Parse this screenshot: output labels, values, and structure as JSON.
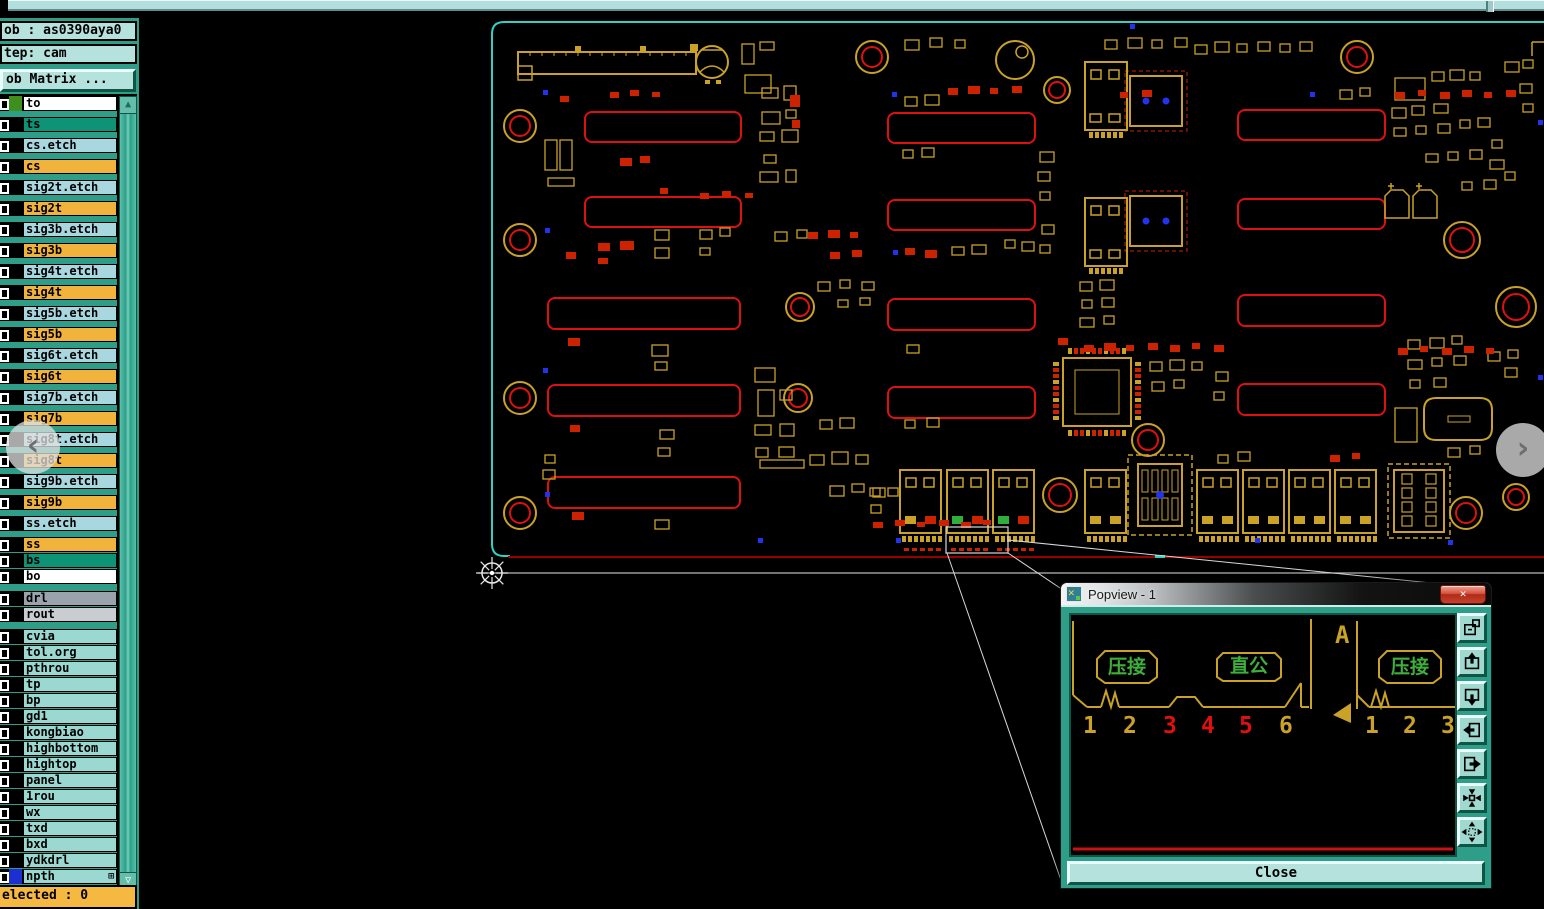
{
  "window": {
    "top_strip": "window-edge"
  },
  "panel": {
    "job_field": "ob : as0390aya0",
    "step_field": "tep: cam",
    "matrix_button": "ob Matrix ...",
    "status": "elected : 0",
    "scroll_up": "▲",
    "scroll_down": "▽",
    "npth_badge": "⊞",
    "layers": [
      {
        "name": "to",
        "bg": "#ffffff",
        "swatch": "#3f8f1f",
        "g": 6
      },
      {
        "name": "ts",
        "bg": "#0f9377",
        "g": 6
      },
      {
        "name": "cs.etch",
        "bg": "#a9d7e0",
        "g": 6
      },
      {
        "name": "cs",
        "bg": "#f2b33d",
        "g": 6
      },
      {
        "name": "sig2t.etch",
        "bg": "#a9d7e0",
        "g": 6
      },
      {
        "name": "sig2t",
        "bg": "#f2b33d",
        "g": 6
      },
      {
        "name": "sig3b.etch",
        "bg": "#a9d7e0",
        "g": 6
      },
      {
        "name": "sig3b",
        "bg": "#f2b33d",
        "g": 6
      },
      {
        "name": "sig4t.etch",
        "bg": "#a9d7e0",
        "g": 6
      },
      {
        "name": "sig4t",
        "bg": "#f2b33d",
        "g": 6
      },
      {
        "name": "sig5b.etch",
        "bg": "#a9d7e0",
        "g": 6
      },
      {
        "name": "sig5b",
        "bg": "#f2b33d",
        "g": 6
      },
      {
        "name": "sig6t.etch",
        "bg": "#a9d7e0",
        "g": 6
      },
      {
        "name": "sig6t",
        "bg": "#f2b33d",
        "g": 6
      },
      {
        "name": "sig7b.etch",
        "bg": "#a9d7e0",
        "g": 6
      },
      {
        "name": "sig7b",
        "bg": "#f2b33d",
        "g": 6
      },
      {
        "name": "sig8t.etch",
        "bg": "#a9d7e0",
        "g": 6
      },
      {
        "name": "sig8t",
        "bg": "#f2b33d",
        "g": 6
      },
      {
        "name": "sig9b.etch",
        "bg": "#a9d7e0",
        "g": 6
      },
      {
        "name": "sig9b",
        "bg": "#f2b33d",
        "g": 6
      },
      {
        "name": "ss.etch",
        "bg": "#a9d7e0",
        "g": 6
      },
      {
        "name": "ss",
        "bg": "#f2b33d",
        "g": 1
      },
      {
        "name": "bs",
        "bg": "#0f9377",
        "g": 1
      },
      {
        "name": "bo",
        "bg": "#ffffff",
        "g": 7
      },
      {
        "name": "drl",
        "bg": "#9aa3ab",
        "g": 1
      },
      {
        "name": "rout",
        "bg": "#c9ccd0",
        "g": 7
      },
      {
        "name": "cvia",
        "bg": "#9bd8d2",
        "g": 1
      },
      {
        "name": "tol.org",
        "bg": "#9bd8d2",
        "g": 1
      },
      {
        "name": "pthrou",
        "bg": "#9bd8d2",
        "g": 1
      },
      {
        "name": "tp",
        "bg": "#9bd8d2",
        "g": 1
      },
      {
        "name": "bp",
        "bg": "#9bd8d2",
        "g": 1
      },
      {
        "name": "gd1",
        "bg": "#9bd8d2",
        "g": 1
      },
      {
        "name": "kongbiao",
        "bg": "#9bd8d2",
        "g": 1
      },
      {
        "name": "highbottom",
        "bg": "#9bd8d2",
        "g": 1
      },
      {
        "name": "hightop",
        "bg": "#9bd8d2",
        "g": 1
      },
      {
        "name": "panel",
        "bg": "#9bd8d2",
        "g": 1
      },
      {
        "name": "1rou",
        "bg": "#9bd8d2",
        "g": 1
      },
      {
        "name": "wx",
        "bg": "#9bd8d2",
        "g": 1
      },
      {
        "name": "txd",
        "bg": "#9bd8d2",
        "g": 1
      },
      {
        "name": "bxd",
        "bg": "#9bd8d2",
        "g": 1
      },
      {
        "name": "ydkdrl",
        "bg": "#9bd8d2",
        "g": 1
      },
      {
        "name": "npth",
        "bg": "#9bd8d2",
        "swatch": "#1d2fd0",
        "badge": "⊞",
        "g": 1
      }
    ]
  },
  "popview": {
    "title": "Popview - 1",
    "close_x": "✕",
    "close_label": "Close",
    "corner_letter": "A",
    "boxes": [
      {
        "text": "压接"
      },
      {
        "text": "直公"
      },
      {
        "text": "压接"
      }
    ],
    "pins_left": [
      {
        "label": "1",
        "color": "#c9a227"
      },
      {
        "label": "2",
        "color": "#c9a227"
      },
      {
        "label": "3",
        "color": "#e01010"
      },
      {
        "label": "4",
        "color": "#e01010"
      },
      {
        "label": "5",
        "color": "#e01010"
      },
      {
        "label": "6",
        "color": "#c9a227"
      }
    ],
    "pins_right": [
      {
        "label": "1",
        "color": "#c9a227"
      },
      {
        "label": "2",
        "color": "#c9a227"
      },
      {
        "label": "3",
        "color": "#c9a227"
      }
    ],
    "tool_buttons": [
      {
        "name": "new-popview-button",
        "icon": "copy-view-icon"
      },
      {
        "name": "pan-up-button",
        "icon": "pan-up-icon"
      },
      {
        "name": "pan-down-button",
        "icon": "pan-down-icon"
      },
      {
        "name": "pan-left-button",
        "icon": "pan-left-icon"
      },
      {
        "name": "pan-right-button",
        "icon": "pan-right-icon"
      },
      {
        "name": "zoom-in-button",
        "icon": "arrows-inward-icon"
      },
      {
        "name": "zoom-out-button",
        "icon": "arrows-outward-icon"
      }
    ]
  },
  "overlays": {
    "left_chevron": "‹",
    "right_chevron": "›"
  },
  "colors": {
    "board_outline": "#35d0c5",
    "silk_yellow": "#c9a227",
    "pad_red": "#cc2200",
    "slot_red": "#dd1111",
    "via_blue": "#2233ee",
    "board_bottom_line": "#990000",
    "datum_gray": "#b9b9b9",
    "leader_white": "#d8d8d8",
    "popview_green": "#3fae3c",
    "popview_red_line": "#cc1111"
  }
}
